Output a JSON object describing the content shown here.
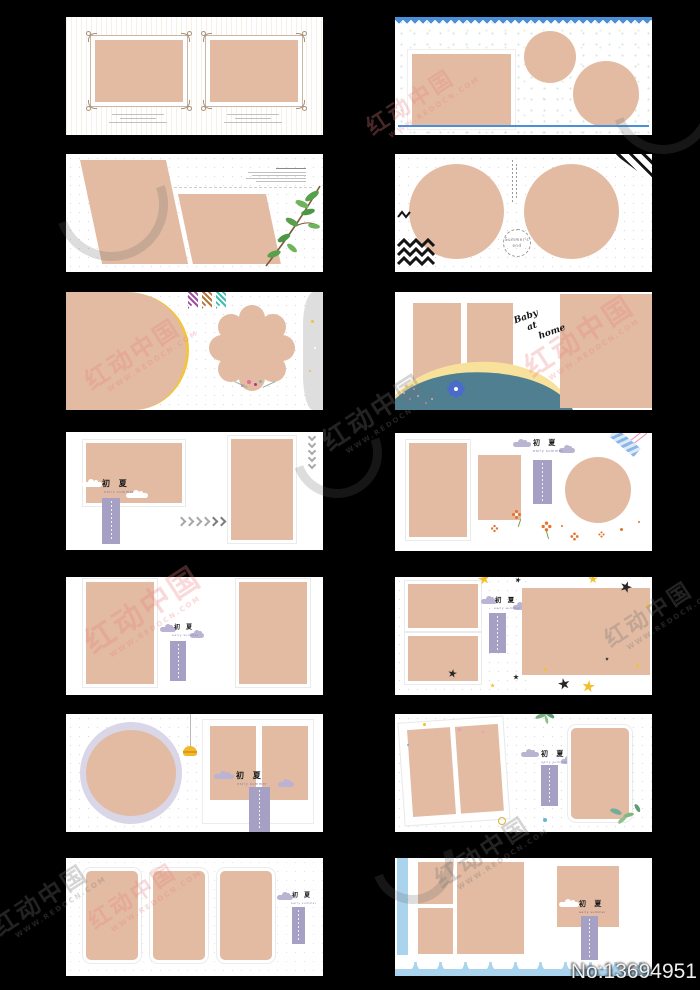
{
  "page": {
    "id_label": "No:13694951",
    "background": "#000000"
  },
  "watermark": {
    "brand": "红动中国",
    "url": "WWW.REDOCN.COM"
  },
  "chuxia": {
    "title": "初 夏",
    "subtitle": "early summer"
  },
  "baby": {
    "line1": "Baby",
    "line2": "at",
    "line3": "home"
  },
  "stamp": {
    "line1": "Summer's",
    "line2": "end"
  },
  "colors": {
    "photo": "#e2bba2",
    "blue": "#4a90d9",
    "lightblue": "#aad4ee",
    "teal": "#4f7f90",
    "bandyellow": "#f8e29b",
    "yellow": "#f2b72e",
    "purple": "#a7a0c5",
    "lavender": "#bab3d2",
    "green": "#58a04b",
    "orange": "#e8702a",
    "pink": "#e78ab0",
    "graywave": "#dedede"
  }
}
